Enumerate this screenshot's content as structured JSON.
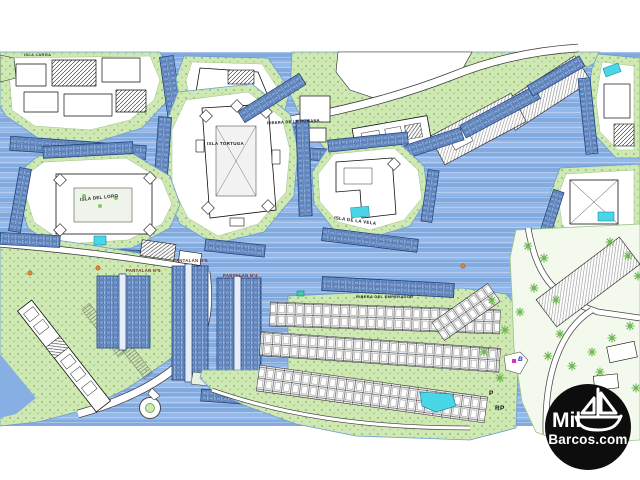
{
  "map": {
    "labels": {
      "isla_larga": "ISLA LARGA",
      "isla_tortuga": "ISLA TORTUGA",
      "isla_del_loro": "ISLA DEL LORO",
      "isla_de_la_vela": "ISLA DE LA VELA",
      "ribera_de_la_romana": "RIBERA DE LA ROMANA",
      "ribera_del_emperador": "RIBERA DEL EMPERADOR",
      "pantalan_n6": "PANTALÁN Nº6",
      "pantalan_n5": "PANTALÁN Nº5",
      "pantalan_n4": "PANTALÁN Nº4",
      "marker_b": "B",
      "marker_p": "P",
      "marker_rp": "RP"
    },
    "colors": {
      "water": "#87AFE4",
      "water_stripe": "#A5C6F0",
      "land": "#CFE8B4",
      "land_speckle": "#8CC56B",
      "berth_fill": "#93B3DD",
      "berth_line": "#2A4F92",
      "pool": "#49D6E6",
      "building_ink": "#111111",
      "pantalan_label_color": "#7A2A1A",
      "marker_blue": "#3322CC",
      "marker_magenta": "#D633C4"
    }
  },
  "logo": {
    "line1": "Mil",
    "line2": "Barcos.com",
    "icon": "sailboat-icon",
    "background": "#0D0D0D",
    "text_color": "#FFFFFF"
  }
}
